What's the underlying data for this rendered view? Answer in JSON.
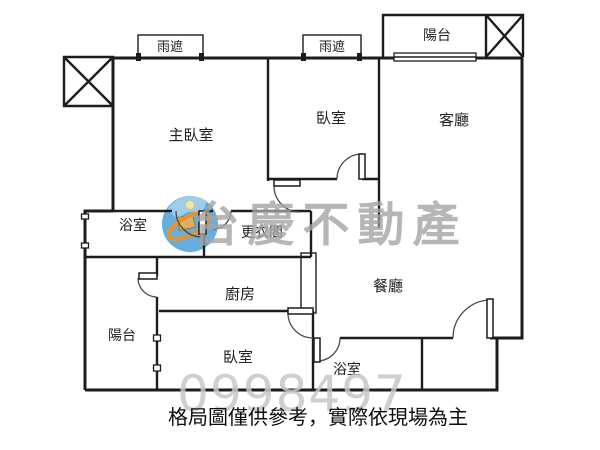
{
  "floor_plan": {
    "rooms": {
      "master_bedroom": "主臥室",
      "bedroom_top": "臥室",
      "living_room": "客廳",
      "balcony_top": "陽台",
      "rain_shade_left": "雨遮",
      "rain_shade_right": "雨遮",
      "bathroom_upper": "浴室",
      "walk_in_closet": "更衣間",
      "kitchen": "廚房",
      "dining_room": "餐廳",
      "balcony_left": "陽台",
      "bedroom_bottom": "臥室",
      "bathroom_lower": "浴室"
    },
    "watermark": {
      "brand": "台慶不動產",
      "number": "0998497"
    },
    "disclaimer": "格局圖僅供參考，實際依現場為主",
    "colors": {
      "wall": "#1c1c1c",
      "watermark_text": "#a5a5a5",
      "watermark_number": "#c7c7c7",
      "logo_blue": "#66aedd",
      "logo_blue_light": "#aad4ee",
      "logo_orange": "#e8922e",
      "logo_yellow": "#efe5ae"
    }
  }
}
